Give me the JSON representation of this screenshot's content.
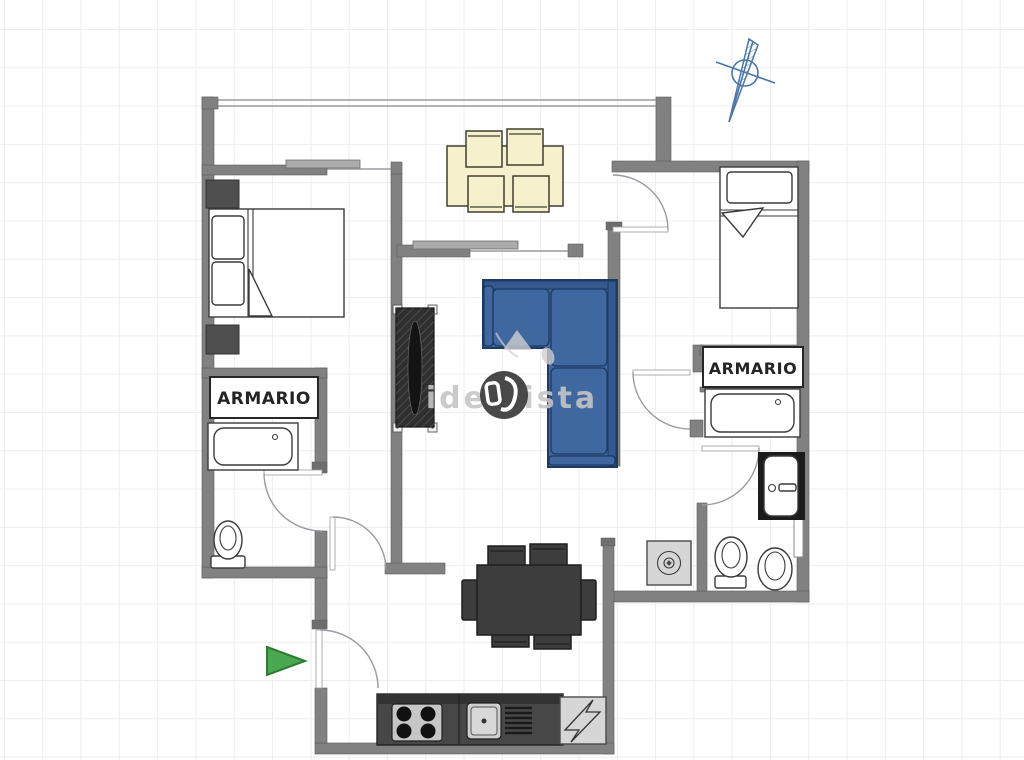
{
  "labels": {
    "wardrobe_left": "ARMARIO",
    "wardrobe_right": "ARMARIO"
  },
  "watermark": {
    "brand": "idealista"
  },
  "furniture": [
    "double-bed",
    "single-bed",
    "wardrobe-left",
    "wardrobe-right",
    "bathtub-left",
    "bathtub-right",
    "toilet-left",
    "toilet-right",
    "bidet",
    "washbasin",
    "washing-machine",
    "corner-sofa",
    "dining-table-light",
    "dining-table-dark",
    "shelf-unit",
    "kitchen-counter",
    "stove",
    "kitchen-sink",
    "fridge",
    "entrance-arrow",
    "north-compass"
  ],
  "colors": {
    "grid": "#ededf2",
    "wall": "#818181",
    "wall_dark": "#5d5d5d",
    "fixture_stroke": "#3a3a3a",
    "sofa": "#3f67a0",
    "sofa_back": "#35598f",
    "sofa_dark": "#1d3a63",
    "cream": "#f5f1cd",
    "cream_border": "#3f3f2e",
    "dark_furniture": "#3d3d3d",
    "dark_border": "#1f1f1f",
    "appliance_gray": "#d6d6d6",
    "green_arrow": "#4aa850",
    "green_border": "#2f7a33",
    "compass_blue": "#4a76a8",
    "watermark_gray": "#c6c6c6",
    "logo_dark": "#3b3b3b"
  }
}
